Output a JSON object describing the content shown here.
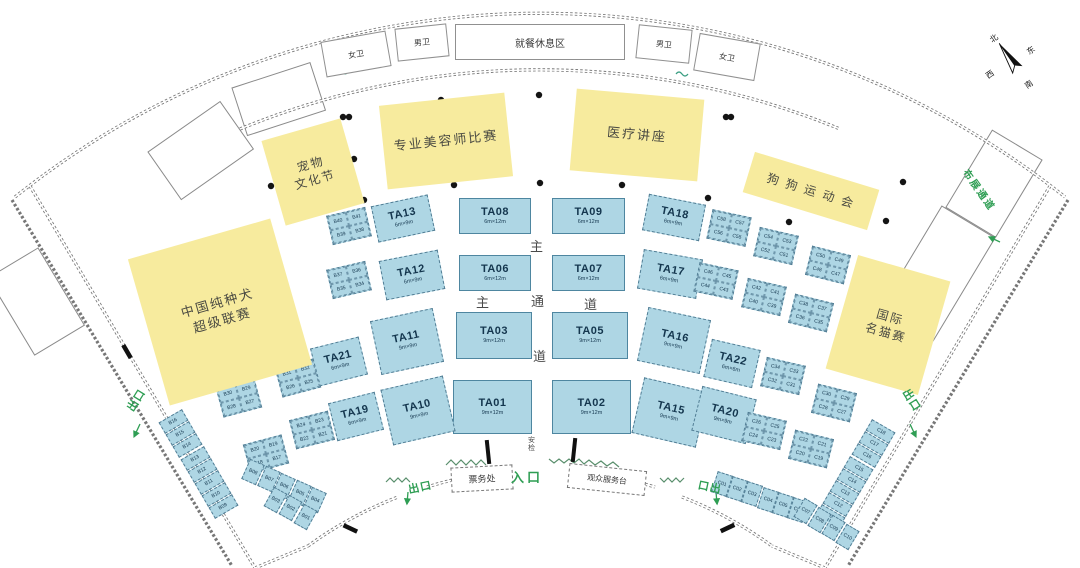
{
  "colors": {
    "booth_fill": "#aed6e4",
    "booth_border": "#527e95",
    "event_fill": "#f7eb9e",
    "accent_green": "#2f9e54",
    "wall_gray": "#777777",
    "booth_text": "#14364e"
  },
  "compass": {
    "north": "北",
    "east": "东",
    "south": "南",
    "west": "西"
  },
  "facilities": [
    {
      "id": "dining-area",
      "label": "就餐休息区",
      "x": 455,
      "y": 24,
      "w": 170,
      "h": 36,
      "rot": 0,
      "fs": 10,
      "border": "solid"
    },
    {
      "id": "restroom-women-left",
      "label": "女卫",
      "x": 323,
      "y": 36,
      "w": 66,
      "h": 36,
      "rot": -10,
      "fs": 8,
      "border": "solid"
    },
    {
      "id": "restroom-men-left",
      "label": "男卫",
      "x": 396,
      "y": 26,
      "w": 52,
      "h": 33,
      "rot": -6,
      "fs": 8,
      "border": "solid"
    },
    {
      "id": "restroom-men-right",
      "label": "男卫",
      "x": 637,
      "y": 27,
      "w": 54,
      "h": 34,
      "rot": 6,
      "fs": 8,
      "border": "solid"
    },
    {
      "id": "restroom-women-right",
      "label": "女卫",
      "x": 696,
      "y": 38,
      "w": 62,
      "h": 38,
      "rot": 10,
      "fs": 8,
      "border": "solid"
    },
    {
      "id": "ticket-office",
      "label": "票务处",
      "x": 451,
      "y": 466,
      "w": 62,
      "h": 25,
      "rot": -3,
      "fs": 9,
      "border": "dashed"
    },
    {
      "id": "visitor-service-desk",
      "label": "观众服务台",
      "x": 568,
      "y": 467,
      "w": 78,
      "h": 25,
      "rot": 6,
      "fs": 8,
      "border": "dashed"
    }
  ],
  "events": [
    {
      "id": "pet-culture-festival",
      "lines": [
        "宠物",
        "文化节"
      ],
      "x": 272,
      "y": 128,
      "w": 82,
      "h": 88,
      "rot": -16,
      "fs": 12
    },
    {
      "id": "groomer-competition",
      "lines": [
        "专业美容师比赛"
      ],
      "x": 383,
      "y": 99,
      "w": 126,
      "h": 84,
      "rot": -6,
      "fs": 13
    },
    {
      "id": "medical-lecture",
      "lines": [
        "医疗讲座"
      ],
      "x": 573,
      "y": 94,
      "w": 128,
      "h": 82,
      "rot": 5,
      "fs": 13
    },
    {
      "id": "dog-sports-meet",
      "lines": [
        "狗 狗 运 动 会"
      ],
      "x": 746,
      "y": 170,
      "w": 130,
      "h": 42,
      "rot": 17,
      "fs": 12
    },
    {
      "id": "china-purebred-super-league",
      "lines": [
        "中国纯种犬",
        "超级联赛"
      ],
      "x": 146,
      "y": 236,
      "w": 148,
      "h": 152,
      "rot": -16,
      "fs": 13
    },
    {
      "id": "intl-cat-show",
      "lines": [
        "国际",
        "名猫赛"
      ],
      "x": 840,
      "y": 266,
      "w": 96,
      "h": 118,
      "rot": 16,
      "fs": 12
    }
  ],
  "ta_booths": [
    {
      "id": "TA08",
      "size": "6m×12m",
      "x": 459,
      "y": 198,
      "w": 72,
      "h": 36,
      "rot": 0,
      "dashed": false
    },
    {
      "id": "TA09",
      "size": "6m×12m",
      "x": 552,
      "y": 198,
      "w": 73,
      "h": 36,
      "rot": 0,
      "dashed": false
    },
    {
      "id": "TA06",
      "size": "6m×12m",
      "x": 459,
      "y": 255,
      "w": 72,
      "h": 36,
      "rot": 0,
      "dashed": false
    },
    {
      "id": "TA07",
      "size": "6m×12m",
      "x": 552,
      "y": 255,
      "w": 73,
      "h": 36,
      "rot": 0,
      "dashed": false
    },
    {
      "id": "TA03",
      "size": "9m×12m",
      "x": 456,
      "y": 312,
      "w": 76,
      "h": 47,
      "rot": 0,
      "dashed": false
    },
    {
      "id": "TA05",
      "size": "9m×12m",
      "x": 552,
      "y": 312,
      "w": 76,
      "h": 47,
      "rot": 0,
      "dashed": false
    },
    {
      "id": "TA01",
      "size": "9m×12m",
      "x": 453,
      "y": 380,
      "w": 79,
      "h": 54,
      "rot": 0,
      "dashed": false
    },
    {
      "id": "TA02",
      "size": "9m×12m",
      "x": 552,
      "y": 380,
      "w": 79,
      "h": 54,
      "rot": 0,
      "dashed": false
    },
    {
      "id": "TA13",
      "size": "6m×9m",
      "x": 374,
      "y": 200,
      "w": 58,
      "h": 37,
      "rot": -12,
      "dashed": true
    },
    {
      "id": "TA12",
      "size": "6m×9m",
      "x": 382,
      "y": 255,
      "w": 60,
      "h": 40,
      "rot": -11,
      "dashed": true
    },
    {
      "id": "TA11",
      "size": "9m×9m",
      "x": 375,
      "y": 314,
      "w": 64,
      "h": 55,
      "rot": -12,
      "dashed": true
    },
    {
      "id": "TA10",
      "size": "9m×9m",
      "x": 386,
      "y": 382,
      "w": 64,
      "h": 57,
      "rot": -13,
      "dashed": true
    },
    {
      "id": "TA21",
      "size": "6m×9m",
      "x": 314,
      "y": 342,
      "w": 50,
      "h": 39,
      "rot": -14,
      "dashed": true
    },
    {
      "id": "TA19",
      "size": "6m×9m",
      "x": 332,
      "y": 397,
      "w": 48,
      "h": 39,
      "rot": -14,
      "dashed": true
    },
    {
      "id": "TA18",
      "size": "6m×9m",
      "x": 645,
      "y": 199,
      "w": 58,
      "h": 37,
      "rot": 11,
      "dashed": true
    },
    {
      "id": "TA17",
      "size": "6m×9m",
      "x": 640,
      "y": 254,
      "w": 60,
      "h": 40,
      "rot": 10,
      "dashed": true
    },
    {
      "id": "TA16",
      "size": "9m×9m",
      "x": 642,
      "y": 313,
      "w": 64,
      "h": 55,
      "rot": 12,
      "dashed": true
    },
    {
      "id": "TA15",
      "size": "9m×9m",
      "x": 637,
      "y": 384,
      "w": 66,
      "h": 57,
      "rot": 13,
      "dashed": true
    },
    {
      "id": "TA22",
      "size": "6m×6m",
      "x": 707,
      "y": 344,
      "w": 50,
      "h": 39,
      "rot": 13,
      "dashed": true
    },
    {
      "id": "TA20",
      "size": "9m×9m",
      "x": 696,
      "y": 392,
      "w": 56,
      "h": 46,
      "rot": 14,
      "dashed": true
    }
  ],
  "clusters": [
    {
      "cells": [
        "B40",
        "B41",
        "B39",
        "B38"
      ],
      "x": 329,
      "y": 211,
      "rot": -13
    },
    {
      "cells": [
        "B37",
        "B36",
        "B35",
        "B34"
      ],
      "x": 329,
      "y": 265,
      "rot": -13
    },
    {
      "cells": [
        "B31",
        "B32",
        "B26",
        "B25"
      ],
      "x": 278,
      "y": 363,
      "rot": -15
    },
    {
      "cells": [
        "B30",
        "B29",
        "B28",
        "B27"
      ],
      "x": 219,
      "y": 383,
      "rot": -15
    },
    {
      "cells": [
        "B24",
        "B23",
        "B22",
        "B21"
      ],
      "x": 292,
      "y": 415,
      "rot": -14
    },
    {
      "cells": [
        "B20",
        "B19",
        "B18",
        "B17"
      ],
      "x": 246,
      "y": 439,
      "rot": -15
    },
    {
      "cells": [
        "C58",
        "C57",
        "C56",
        "C55"
      ],
      "x": 709,
      "y": 213,
      "rot": 12
    },
    {
      "cells": [
        "C54",
        "C53",
        "C52",
        "C51"
      ],
      "x": 756,
      "y": 231,
      "rot": 13
    },
    {
      "cells": [
        "C50",
        "C49",
        "C48",
        "C47"
      ],
      "x": 808,
      "y": 250,
      "rot": 14
    },
    {
      "cells": [
        "C46",
        "C45",
        "C44",
        "C43"
      ],
      "x": 696,
      "y": 266,
      "rot": 12
    },
    {
      "cells": [
        "C42",
        "C41",
        "C40",
        "C39"
      ],
      "x": 744,
      "y": 282,
      "rot": 13
    },
    {
      "cells": [
        "C38",
        "C37",
        "C36",
        "C35"
      ],
      "x": 791,
      "y": 298,
      "rot": 14
    },
    {
      "cells": [
        "C34",
        "C33",
        "C32",
        "C31"
      ],
      "x": 763,
      "y": 361,
      "rot": 13
    },
    {
      "cells": [
        "C30",
        "C29",
        "C28",
        "C27"
      ],
      "x": 814,
      "y": 388,
      "rot": 14
    },
    {
      "cells": [
        "C26",
        "C25",
        "C24",
        "C23"
      ],
      "x": 744,
      "y": 416,
      "rot": 13
    },
    {
      "cells": [
        "C22",
        "C21",
        "C20",
        "C19"
      ],
      "x": 791,
      "y": 434,
      "rot": 14
    }
  ],
  "strips": [
    {
      "cells": [
        "B16",
        "B15",
        "B14",
        "B13",
        "B12",
        "B11",
        "B10",
        "B09"
      ],
      "x0": 167,
      "y0": 408,
      "dx": 7.2,
      "dy": 12.2,
      "cw": 13,
      "ch": 27,
      "rot": 60,
      "lr": -90
    },
    {
      "cells": [
        "B08",
        "B07",
        "B06",
        "B05",
        "B04"
      ],
      "x0": 245,
      "y0": 461,
      "dx": 15.6,
      "dy": 7.0,
      "cw": 16,
      "ch": 22,
      "rot": 24,
      "lr": 0
    },
    {
      "cells": [
        "B03",
        "B02",
        "B01"
      ],
      "x0": 268,
      "y0": 489,
      "dx": 14.9,
      "dy": 8.4,
      "cw": 15,
      "ch": 22,
      "rot": 29,
      "lr": 0
    },
    {
      "cells": [
        "C18",
        "C17",
        "C16",
        "C15",
        "C14",
        "C13",
        "C12",
        "C11"
      ],
      "x0": 874,
      "y0": 418,
      "dx": -7.2,
      "dy": 12.2,
      "cw": 13,
      "ch": 27,
      "rot": -60,
      "lr": 90
    },
    {
      "cells": [
        "C01",
        "C02",
        "C03",
        "C04",
        "C05",
        "C06"
      ],
      "x0": 714,
      "y0": 473,
      "dx": 15.2,
      "dy": 5.2,
      "cw": 16,
      "ch": 22,
      "rot": 18,
      "lr": 0
    },
    {
      "cells": [
        "C07",
        "C08",
        "C09",
        "C10"
      ],
      "x0": 798,
      "y0": 500,
      "dx": 14.0,
      "dy": 8.6,
      "cw": 15,
      "ch": 22,
      "rot": 31,
      "lr": 0
    }
  ],
  "corridor_labels": [
    {
      "ch": "主",
      "x": 530,
      "y": 236
    },
    {
      "ch": "主",
      "x": 476,
      "y": 292
    },
    {
      "ch": "通",
      "x": 531,
      "y": 291
    },
    {
      "ch": "道",
      "x": 584,
      "y": 294
    },
    {
      "ch": "道",
      "x": 533,
      "y": 346
    }
  ],
  "security_check": {
    "label": "安检",
    "x": 528,
    "y": 437
  },
  "entrance": {
    "label": "入口",
    "x": 511,
    "y": 467
  },
  "exits": [
    {
      "label": "出口",
      "x": 124,
      "y": 392,
      "rot": -58
    },
    {
      "label": "出口",
      "x": 408,
      "y": 479,
      "rot": -12
    },
    {
      "label": "口出",
      "x": 698,
      "y": 479,
      "rot": 12
    },
    {
      "label": "出口",
      "x": 900,
      "y": 392,
      "rot": 58
    }
  ],
  "setup_passage": {
    "label": "布展通道",
    "x": 956,
    "y": 182,
    "rot": 55
  }
}
